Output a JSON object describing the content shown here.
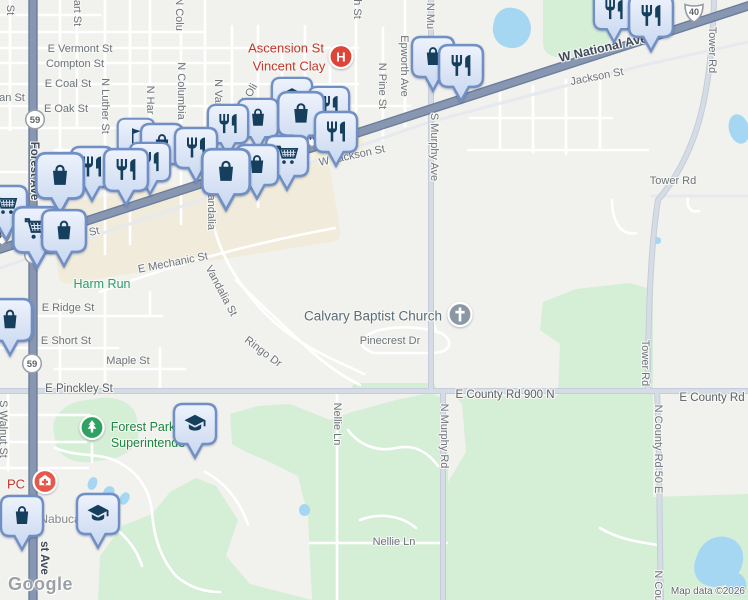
{
  "map": {
    "logo": "Google",
    "attribution": "Map data ©2026",
    "colors": {
      "background": "#f1f1ee",
      "highway": "#8897b1",
      "secondary_road": "#d6dce5",
      "park_green": "#d5eed6",
      "commercial_beige": "#f1ebdb",
      "water": "#a5d7f3",
      "pin_fill_top": "#eef3fc",
      "pin_fill_bottom": "#c7d6ef",
      "pin_border": "#7090c5",
      "pin_icon": "#153f5c",
      "hospital_red": "#dc4538",
      "church_gray": "#8b98a3",
      "park_icon_green": "#2fa163",
      "medical_red": "#e5584b"
    },
    "labels": [
      {
        "text": "E Vermont St",
        "x": 80,
        "y": 49
      },
      {
        "text": "Compton St",
        "x": 75,
        "y": 64
      },
      {
        "text": "E Coal St",
        "x": 68,
        "y": 84
      },
      {
        "text": "E Oak St",
        "x": 66,
        "y": 109
      },
      {
        "text": "an St",
        "x": 12,
        "y": 98
      },
      {
        "text": "E Mechanic St",
        "x": 173,
        "y": 263,
        "rot": -11
      },
      {
        "text": "E Ridge St",
        "x": 68,
        "y": 308
      },
      {
        "text": "E Short St",
        "x": 66,
        "y": 341
      },
      {
        "text": "Maple St",
        "x": 128,
        "y": 361
      },
      {
        "text": "E Pinckley St",
        "x": 79,
        "y": 389,
        "cls": "collector"
      },
      {
        "text": "W Jackson St",
        "x": 352,
        "y": 156,
        "rot": -12
      },
      {
        "text": "son St",
        "x": 84,
        "y": 234,
        "rot": -12
      },
      {
        "text": "Jackson St",
        "x": 597,
        "y": 77,
        "rot": -11
      },
      {
        "text": "W National Ave",
        "x": 603,
        "y": 48,
        "rot": -13,
        "cls": "highway"
      },
      {
        "text": "Tower Rd",
        "x": 673,
        "y": 181
      },
      {
        "text": "Tower Rd",
        "x": 712,
        "y": 50,
        "rot": 90
      },
      {
        "text": "Tower Rd",
        "x": 645,
        "y": 363,
        "rot": 90
      },
      {
        "text": "E County Rd 900 N",
        "x": 505,
        "y": 395,
        "cls": "collector"
      },
      {
        "text": "E County Rd",
        "x": 712,
        "y": 398,
        "cls": "collector"
      },
      {
        "text": "Calvary Baptist Church",
        "x": 373,
        "y": 316,
        "cls": "poi"
      },
      {
        "text": "Pinecrest Dr",
        "x": 390,
        "y": 341
      },
      {
        "text": "Nellie Ln",
        "x": 337,
        "y": 424,
        "rot": 90
      },
      {
        "text": "Nellie Ln",
        "x": 394,
        "y": 542
      },
      {
        "text": "N Murphy Rd",
        "x": 444,
        "y": 436,
        "rot": 90
      },
      {
        "text": "N County Rd 50 E",
        "x": 658,
        "y": 449,
        "rot": 90
      },
      {
        "text": "N Cou",
        "x": 658,
        "y": 586,
        "rot": 90
      },
      {
        "text": "S Murphy Ave",
        "x": 434,
        "y": 147,
        "rot": 90
      },
      {
        "text": "N Mu",
        "x": 430,
        "y": 16,
        "rot": 90
      },
      {
        "text": "Epworth Ave",
        "x": 404,
        "y": 66,
        "rot": 90
      },
      {
        "text": "N Pine St",
        "x": 382,
        "y": 86,
        "rot": 90
      },
      {
        "text": "h St",
        "x": 357,
        "y": 9,
        "rot": 90
      },
      {
        "text": "N Columbia",
        "x": 181,
        "y": 91,
        "rot": 90
      },
      {
        "text": "N Colu",
        "x": 179,
        "y": 14,
        "rot": 90
      },
      {
        "text": "N Luther St",
        "x": 105,
        "y": 106,
        "rot": 90
      },
      {
        "text": "N Har",
        "x": 150,
        "y": 100,
        "rot": 90
      },
      {
        "text": "N Van",
        "x": 218,
        "y": 94,
        "rot": 90
      },
      {
        "text": "Vandalia",
        "x": 211,
        "y": 209,
        "rot": 90
      },
      {
        "text": "Vandalia St",
        "x": 221,
        "y": 291,
        "rot": 62
      },
      {
        "text": "Ringo Dr",
        "x": 263,
        "y": 352,
        "rot": 37
      },
      {
        "text": "E Oli",
        "x": 249,
        "y": 95,
        "rot": -60
      },
      {
        "text": "Forest Ave",
        "x": 34,
        "y": 171,
        "rot": 90,
        "cls": "onroad"
      },
      {
        "text": "st Ave",
        "x": 44,
        "y": 558,
        "rot": 90,
        "cls": "onroad"
      },
      {
        "text": "S Walnut St",
        "x": 3,
        "y": 429,
        "rot": 90
      },
      {
        "text": "art St",
        "x": 77,
        "y": 13,
        "rot": 90
      },
      {
        "text": "St",
        "x": 10,
        "y": 10,
        "rot": 90
      },
      {
        "text": "Harm Run",
        "x": 102,
        "y": 284,
        "cls": "water-label"
      },
      {
        "text": "Ascension St",
        "x": 286,
        "y": 48,
        "cls": "hospital-label"
      },
      {
        "text": "Vincent Clay",
        "x": 289,
        "y": 66,
        "cls": "hospital-label"
      },
      {
        "text": "Forest Park",
        "x": 143,
        "y": 427,
        "cls": "park-label"
      },
      {
        "text": "Superintende",
        "x": 148,
        "y": 443,
        "cls": "park-label"
      },
      {
        "text": "PC",
        "x": 16,
        "y": 484,
        "cls": "hospital-label"
      },
      {
        "text": "Nabuca",
        "x": 60,
        "y": 519,
        "cls": "area-label"
      }
    ],
    "pins": [
      {
        "type": "restaurant",
        "x": 614,
        "y": 10,
        "w": 44
      },
      {
        "type": "restaurant",
        "x": 651,
        "y": 16,
        "w": 48
      },
      {
        "type": "bag",
        "x": 433,
        "y": 57,
        "w": 46
      },
      {
        "type": "restaurant",
        "x": 461,
        "y": 66,
        "w": 48
      },
      {
        "type": "school",
        "x": 292,
        "y": 97,
        "w": 44
      },
      {
        "type": "restaurant",
        "x": 329,
        "y": 106,
        "w": 44
      },
      {
        "type": "bag",
        "x": 258,
        "y": 118,
        "w": 44
      },
      {
        "type": "restaurant",
        "x": 228,
        "y": 124,
        "w": 44
      },
      {
        "type": "bag",
        "x": 301,
        "y": 114,
        "w": 50
      },
      {
        "type": "restaurant",
        "x": 336,
        "y": 132,
        "w": 46
      },
      {
        "type": "flag",
        "x": 136,
        "y": 136,
        "w": 40
      },
      {
        "type": "bag",
        "x": 162,
        "y": 144,
        "w": 46
      },
      {
        "type": "restaurant",
        "x": 196,
        "y": 148,
        "w": 46
      },
      {
        "type": "cart",
        "x": 287,
        "y": 156,
        "w": 46
      },
      {
        "type": "bag",
        "x": 257,
        "y": 165,
        "w": 46
      },
      {
        "type": "bag",
        "x": 226,
        "y": 172,
        "w": 52
      },
      {
        "type": "restaurant",
        "x": 150,
        "y": 162,
        "w": 44
      },
      {
        "type": "restaurant",
        "x": 92,
        "y": 167,
        "w": 46
      },
      {
        "type": "restaurant",
        "x": 126,
        "y": 170,
        "w": 48
      },
      {
        "type": "bag",
        "x": 60,
        "y": 176,
        "w": 52
      },
      {
        "type": "cart",
        "x": 6,
        "y": 206,
        "w": 46
      },
      {
        "type": "cart",
        "x": 37,
        "y": 230,
        "w": 52
      },
      {
        "type": "bag",
        "x": 64,
        "y": 231,
        "w": 48
      },
      {
        "type": "bag",
        "x": 10,
        "y": 320,
        "w": 48
      },
      {
        "type": "school",
        "x": 195,
        "y": 424,
        "w": 46
      },
      {
        "type": "school",
        "x": 98,
        "y": 514,
        "w": 46
      },
      {
        "type": "bag",
        "x": 22,
        "y": 516,
        "w": 46
      }
    ],
    "shields": [
      {
        "kind": "circle",
        "text": "59",
        "x": 35,
        "y": 122
      },
      {
        "kind": "circle",
        "text": "59",
        "x": 34,
        "y": 257
      },
      {
        "kind": "circle",
        "text": "59",
        "x": 32,
        "y": 366
      },
      {
        "kind": "us",
        "text": "40",
        "x": 312,
        "y": 140
      },
      {
        "kind": "us",
        "text": "40",
        "x": 694,
        "y": 15
      },
      {
        "kind": "us",
        "text": "40",
        "x": 2,
        "y": 238
      }
    ],
    "poi_icons": [
      {
        "type": "hospital",
        "x": 341,
        "y": 59
      },
      {
        "type": "church",
        "x": 460,
        "y": 317
      },
      {
        "type": "park",
        "x": 92,
        "y": 430
      },
      {
        "type": "medical",
        "x": 45,
        "y": 484
      }
    ]
  }
}
